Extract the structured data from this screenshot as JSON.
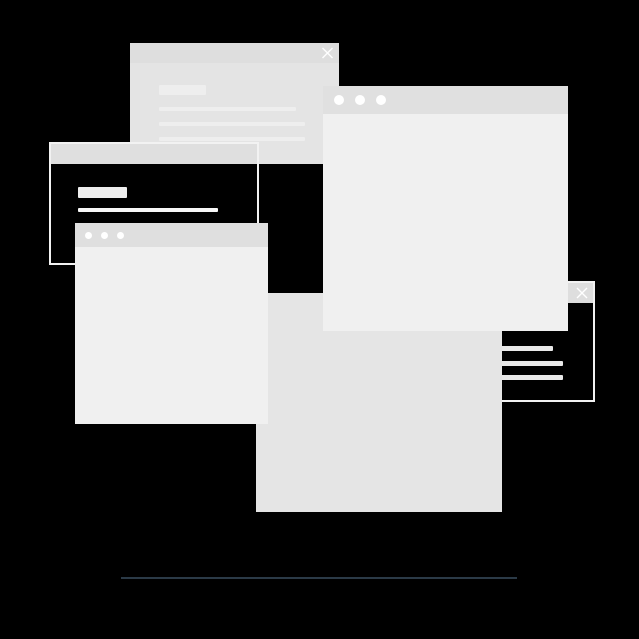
{
  "canvas": {
    "description": "Decorative illustration of five overlapping blank application windows on a black background with a thin divider line below"
  },
  "colors": {
    "background": "#000000",
    "titlebar": "#dfdfdf",
    "titlebar_dark": "#dedede",
    "titlebar_big": "#e0e0e0",
    "window_body_bright": "#f0f0f0",
    "window_body_mid": "#e4e4e4",
    "panel": "#e5e5e5",
    "placeholder": "#eeeeee",
    "line_bright": "#f7f7f7",
    "line_soft": "#e9e9e9",
    "outline": "#f2f2f2",
    "dot": "#ffffff",
    "divider": "#2b3a47"
  },
  "windows": [
    {
      "id": "top-left-window",
      "chrome": "close-button",
      "icons": [
        "close-icon"
      ],
      "content": [
        "label-placeholder",
        "text-line",
        "text-line",
        "text-line"
      ]
    },
    {
      "id": "left-outlined-window",
      "chrome": "plain-titlebar",
      "icons": [],
      "content": [
        "label-placeholder",
        "text-line"
      ]
    },
    {
      "id": "left-dots-window",
      "chrome": "traffic-dots",
      "dots": 3,
      "content": []
    },
    {
      "id": "big-right-window",
      "chrome": "traffic-dots",
      "dots": 3,
      "content": []
    },
    {
      "id": "center-panel",
      "chrome": "none",
      "content": []
    },
    {
      "id": "right-outlined-window",
      "chrome": "close-button",
      "icons": [
        "close-icon"
      ],
      "content": [
        "text-line",
        "text-line",
        "text-line"
      ]
    }
  ],
  "icons": {
    "close": "✕",
    "window_dot": "●"
  }
}
